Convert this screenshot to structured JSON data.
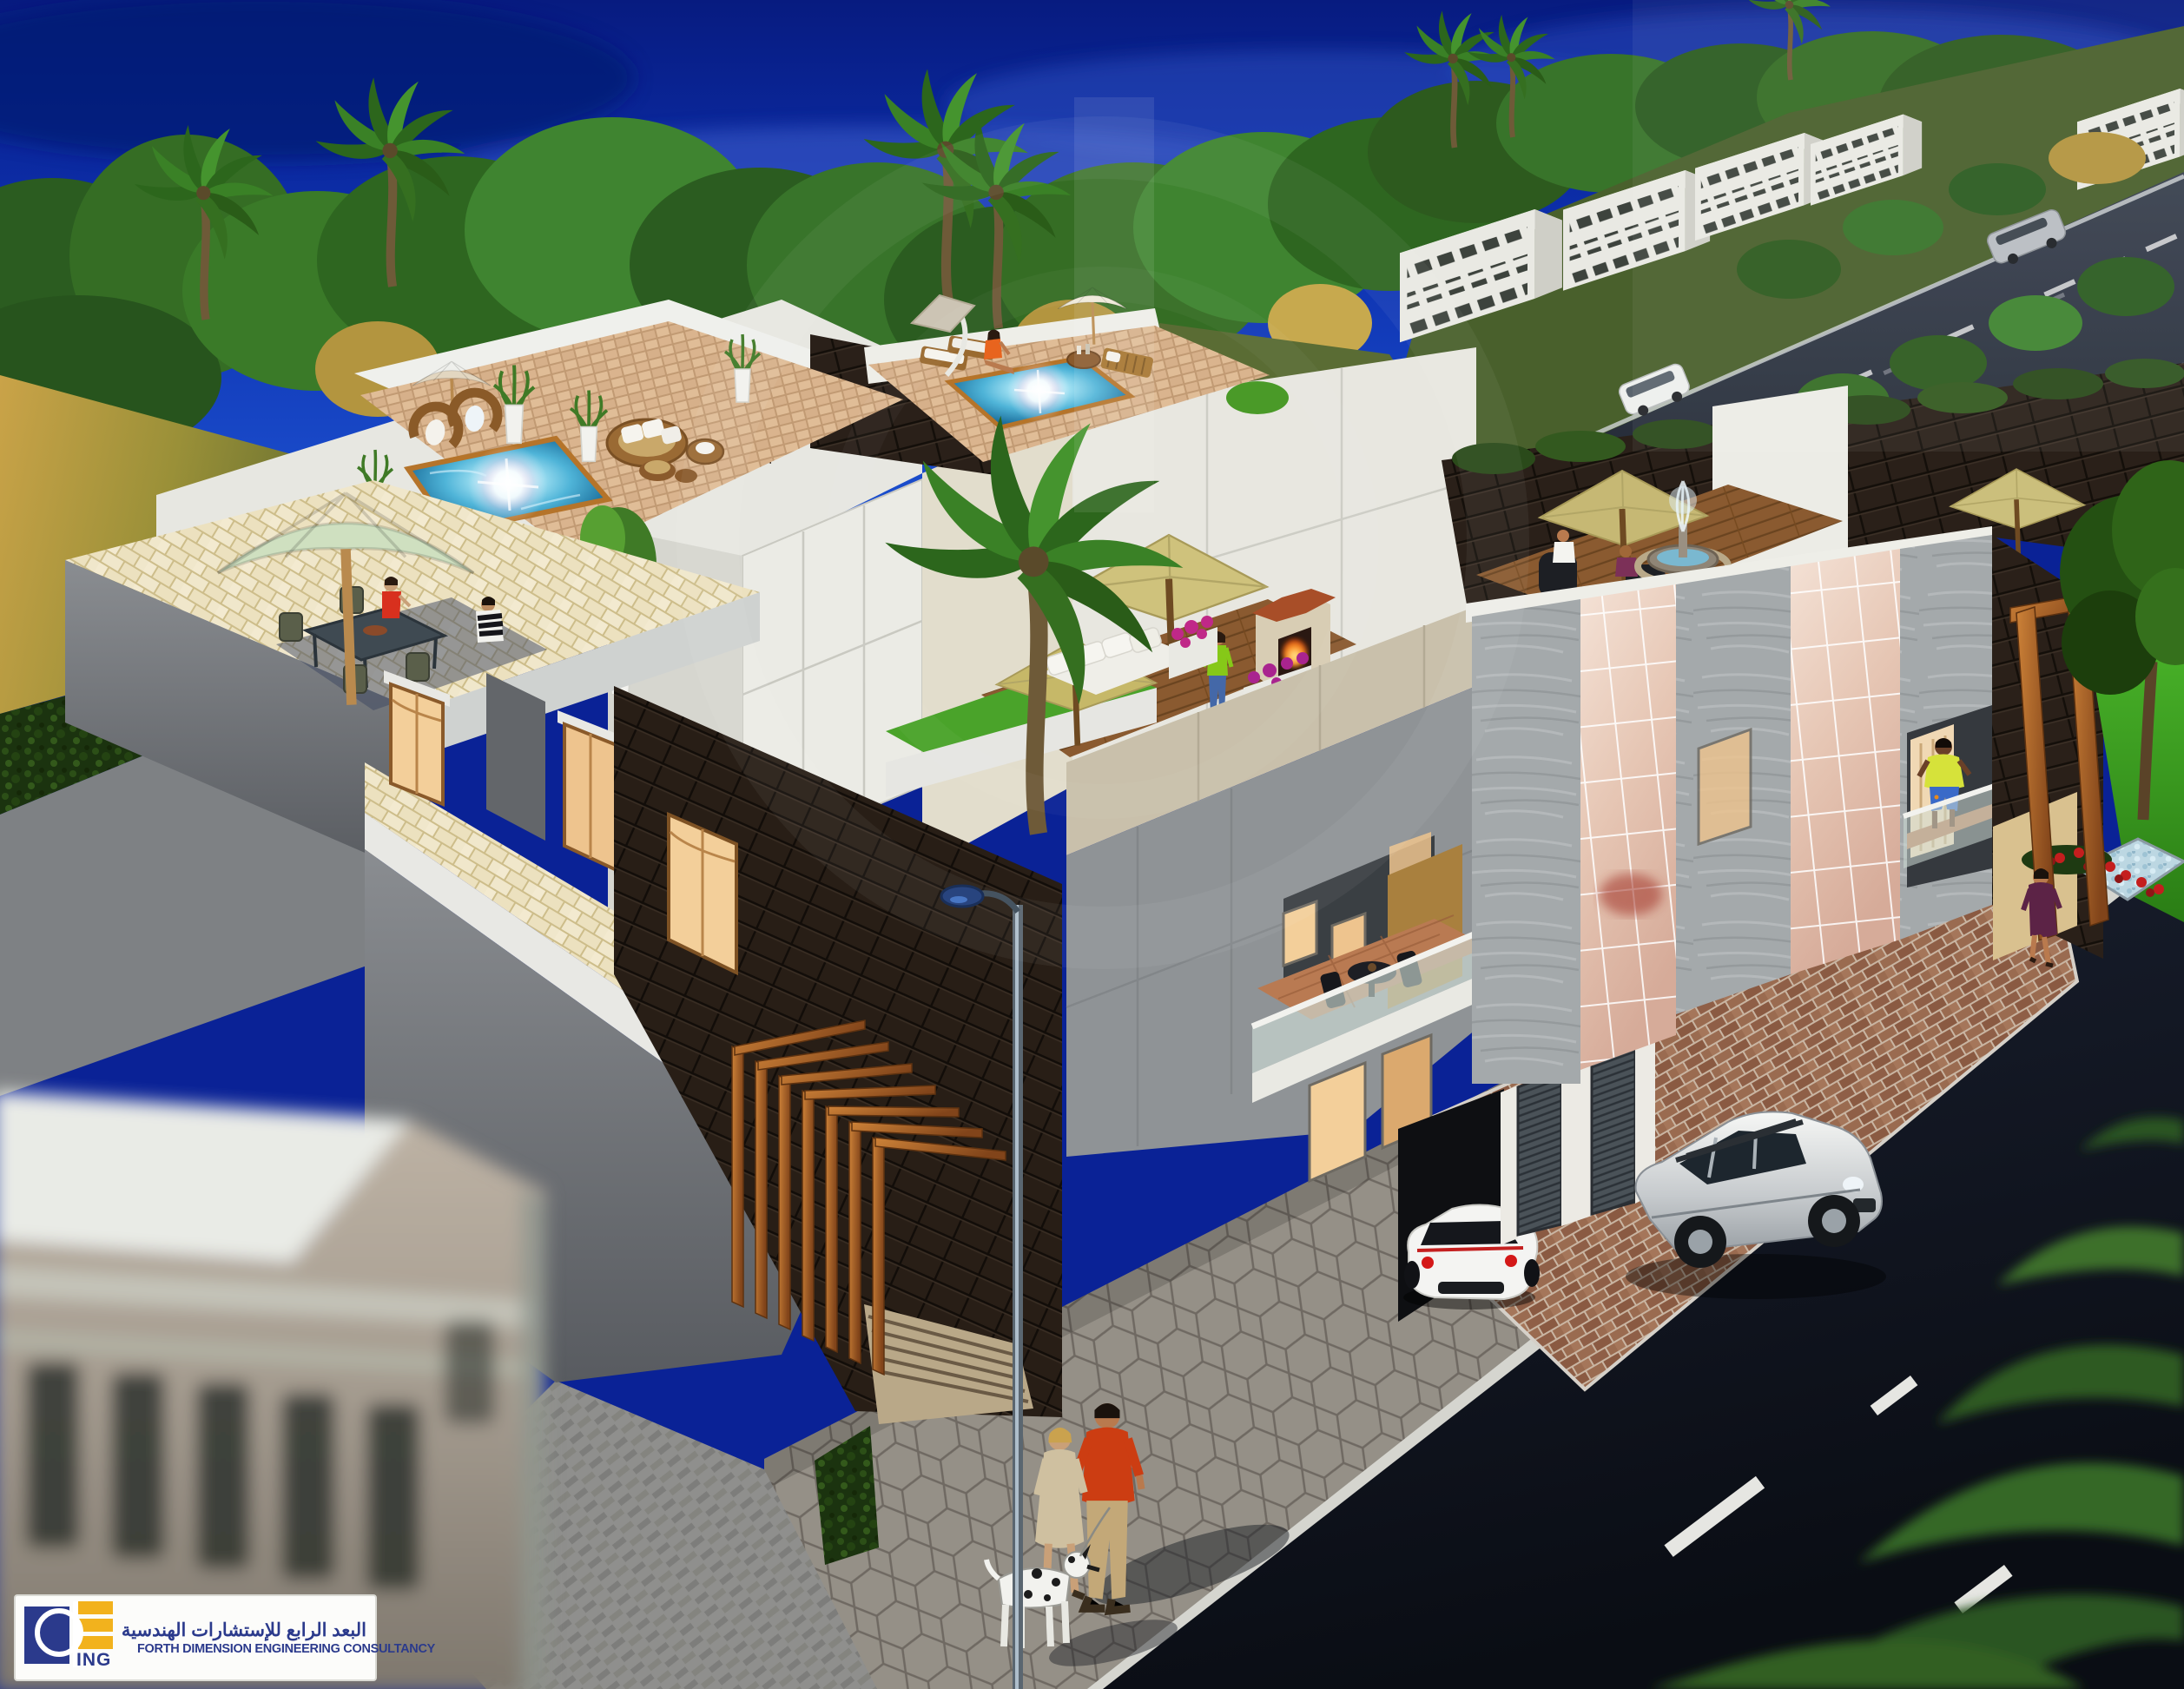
{
  "logo": {
    "mark_text": "ING",
    "arabic_name": "البعد الرابع للإستشارات الهندسية",
    "english_name": "FORTH DIMENSION ENGINEERING CONSULTANCY"
  },
  "palette": {
    "brand_navy": "#2b3a8c",
    "brand_gold": "#f2b21d",
    "sky_top": "#081d86",
    "sky_bottom": "#1c50cf",
    "villa_white": "#e9e9e4",
    "dark_tile": "#261c15",
    "wood_accent": "#b5682a",
    "pool_water": "#2b8fc0",
    "lawn_green": "#3fa823",
    "asphalt": "#10141d",
    "paver_gray": "#9a948e",
    "terrace_tan": "#d9b896",
    "walkway_cream": "#ece3c4",
    "khaki_umbrella": "#c6b874"
  }
}
